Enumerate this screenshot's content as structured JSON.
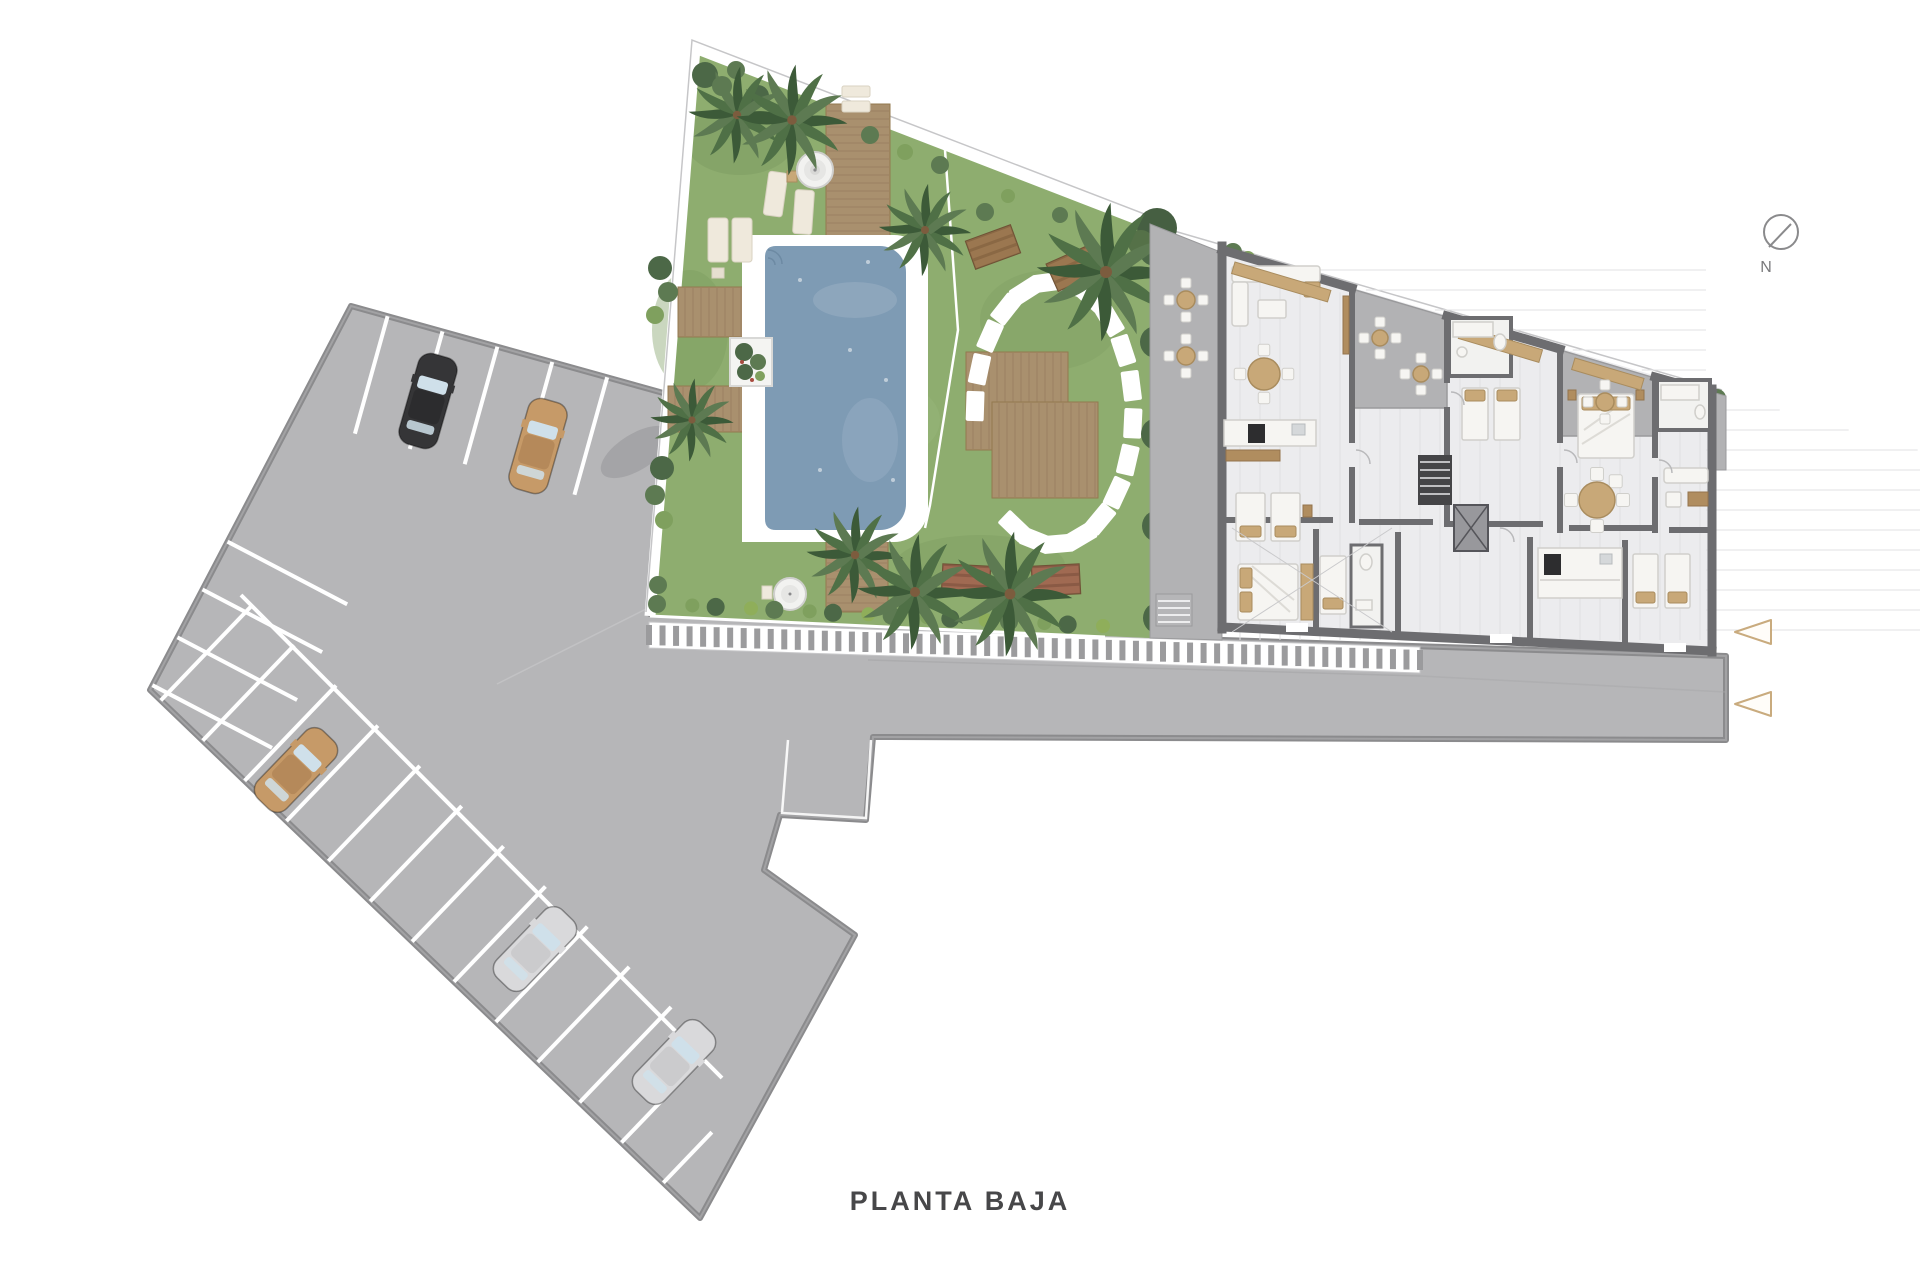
{
  "title": "PLANTA BAJA",
  "compass": {
    "label": "N"
  },
  "palette": {
    "pavement": "#b6b6b8",
    "pavement_border": "#8b8b8d",
    "line_white": "#ffffff",
    "grass": "#8ead6f",
    "grass_dark": "#7b9a5f",
    "wood": "#a9906e",
    "plank": "#8f765a",
    "water": "#7e9bb4",
    "pool_rim": "#ffffff",
    "wall": "#6d6d70",
    "floor": "#ececee",
    "terrace": "#b2b2b4",
    "hedge_dark": "#4c6847",
    "hedge_mid": "#5d7a52",
    "hedge_light": "#7fa05e",
    "hedge_accent": "#8fae5a",
    "cream": "#efe9dc",
    "tan": "#c8a878",
    "stripe_tick": "#9b9b9d",
    "marker_outline": "#c9ab7e",
    "text": "#474749",
    "car_black": "#353537",
    "car_tan": "#c69a68",
    "car_silver": "#d9d9db",
    "window_glass": "#cfe0ea"
  },
  "parking": {
    "rows": [
      {
        "name": "top-row",
        "x": 351,
        "y": 306,
        "ux": 0.963,
        "uy": 0.268,
        "nx": -0.268,
        "ny": 0.963,
        "start": 38,
        "step": 57,
        "count": 5,
        "len": 122
      },
      {
        "name": "left-row",
        "x": 351,
        "y": 306,
        "ux": -0.464,
        "uy": 0.886,
        "nx": 0.886,
        "ny": 0.464,
        "start": 266,
        "step": 54,
        "count": 4,
        "len": 135
      },
      {
        "name": "bottom-row",
        "x": 150,
        "y": 690,
        "ux": 0.722,
        "uy": 0.693,
        "nx": 0.693,
        "ny": -0.722,
        "start": 15,
        "step": 58,
        "count": 13,
        "len": 132,
        "lastLen": 70
      }
    ],
    "head_line": {
      "x1": 241,
      "y1": 595,
      "x2": 722,
      "y2": 1078
    },
    "cars": [
      {
        "body": "#353537",
        "roof": "#2c2c2e",
        "cx": 428,
        "cy": 401,
        "rot": 16
      },
      {
        "body": "#c69a68",
        "roof": "#b5895a",
        "cx": 538,
        "cy": 446,
        "rot": 16
      },
      {
        "body": "#c69a68",
        "roof": "#b5895a",
        "cx": 296,
        "cy": 770,
        "rot": 44
      },
      {
        "body": "#d9d9db",
        "roof": "#cbcbcd",
        "cx": 535,
        "cy": 949,
        "rot": 44
      },
      {
        "body": "#d9d9db",
        "roof": "#cbcbcd",
        "cx": 674,
        "cy": 1062,
        "rot": 44
      }
    ]
  },
  "crosswalk_band": {
    "x1": 649,
    "y1": 622,
    "x2": 1420,
    "y2": 647,
    "h": 26,
    "stripes": 58
  },
  "stepping_stones": {
    "cx": 1054,
    "cy": 413,
    "rx": 79,
    "ry": 131,
    "count": 21,
    "startDeg": 120,
    "stepDeg": 16.5,
    "skipFrom": 138,
    "skipTo": 182,
    "w": 30,
    "h": 18
  },
  "decks": [
    {
      "x": 826,
      "y": 104,
      "w": 64,
      "h": 143,
      "planks": "h"
    },
    {
      "x": 826,
      "y": 540,
      "w": 62,
      "h": 72,
      "planks": "h"
    },
    {
      "x": 678,
      "y": 287,
      "w": 84,
      "h": 50,
      "planks": "v"
    },
    {
      "x": 668,
      "y": 386,
      "w": 96,
      "h": 46,
      "planks": "v"
    },
    {
      "x": 966,
      "y": 352,
      "w": 102,
      "h": 98,
      "planks": "v"
    },
    {
      "x": 992,
      "y": 402,
      "w": 106,
      "h": 96,
      "planks": "v"
    }
  ],
  "palms": [
    {
      "x": 737,
      "y": 115,
      "s": 1.05
    },
    {
      "x": 792,
      "y": 120,
      "s": 1.2
    },
    {
      "x": 925,
      "y": 230,
      "s": 1.0
    },
    {
      "x": 1106,
      "y": 272,
      "s": 1.5
    },
    {
      "x": 692,
      "y": 420,
      "s": 0.9
    },
    {
      "x": 855,
      "y": 555,
      "s": 1.05
    },
    {
      "x": 915,
      "y": 592,
      "s": 1.25
    },
    {
      "x": 1010,
      "y": 594,
      "s": 1.35
    }
  ],
  "bushes": [
    [
      705,
      75,
      13,
      0
    ],
    [
      722,
      86,
      10,
      1
    ],
    [
      736,
      70,
      9,
      1
    ],
    [
      758,
      96,
      11,
      0
    ],
    [
      660,
      268,
      12,
      0
    ],
    [
      668,
      292,
      10,
      1
    ],
    [
      655,
      315,
      9,
      2
    ],
    [
      662,
      468,
      12,
      0
    ],
    [
      655,
      495,
      10,
      1
    ],
    [
      664,
      520,
      9,
      2
    ],
    [
      658,
      585,
      9,
      1
    ],
    [
      870,
      135,
      9,
      1
    ],
    [
      905,
      152,
      8,
      2
    ],
    [
      940,
      165,
      9,
      1
    ],
    [
      985,
      212,
      9,
      1
    ],
    [
      1008,
      196,
      7,
      2
    ],
    [
      1060,
      215,
      8,
      1
    ],
    [
      1233,
      252,
      9,
      1
    ],
    [
      1248,
      258,
      7,
      2
    ],
    [
      1717,
      398,
      9,
      1
    ],
    [
      1717,
      452,
      8,
      1
    ],
    [
      1164,
      500,
      8,
      1
    ],
    [
      1205,
      470,
      8,
      2
    ],
    [
      1208,
      620,
      9,
      1
    ]
  ],
  "side_hedge": {
    "x1": 1158,
    "y1": 250,
    "x2": 1162,
    "y2": 618,
    "count": 9
  },
  "bottom_hedge": {
    "x1": 660,
    "y1": 604,
    "x2": 1100,
    "y2": 626,
    "count": 16
  },
  "benches": [
    {
      "x": 993,
      "y": 247,
      "rot": -20,
      "c1": "#9b7750",
      "c2": "#8a6844"
    },
    {
      "x": 1074,
      "y": 268,
      "rot": -24,
      "c1": "#9b7750",
      "c2": "#8a6844"
    },
    {
      "x": 966,
      "y": 580,
      "rot": 3,
      "c1": "#a06a52",
      "c2": "#8a5a45"
    },
    {
      "x": 1056,
      "y": 580,
      "rot": -3,
      "c1": "#a06a52",
      "c2": "#8a5a45"
    }
  ],
  "dining_sets": [
    {
      "x": 1186,
      "y": 300,
      "r": 9,
      "chairs": 4
    },
    {
      "x": 1186,
      "y": 356,
      "r": 9,
      "chairs": 4
    },
    {
      "x": 1380,
      "y": 338,
      "r": 8,
      "chairs": 4
    },
    {
      "x": 1421,
      "y": 374,
      "r": 8,
      "chairs": 4
    },
    {
      "x": 1605,
      "y": 402,
      "r": 9,
      "chairs": 4
    },
    {
      "x": 1264,
      "y": 374,
      "r": 16,
      "chairs": 4
    },
    {
      "x": 1597,
      "y": 500,
      "r": 18,
      "chairs": 5
    }
  ],
  "markers": [
    {
      "x": 1735,
      "y": 632
    },
    {
      "x": 1735,
      "y": 704
    }
  ]
}
